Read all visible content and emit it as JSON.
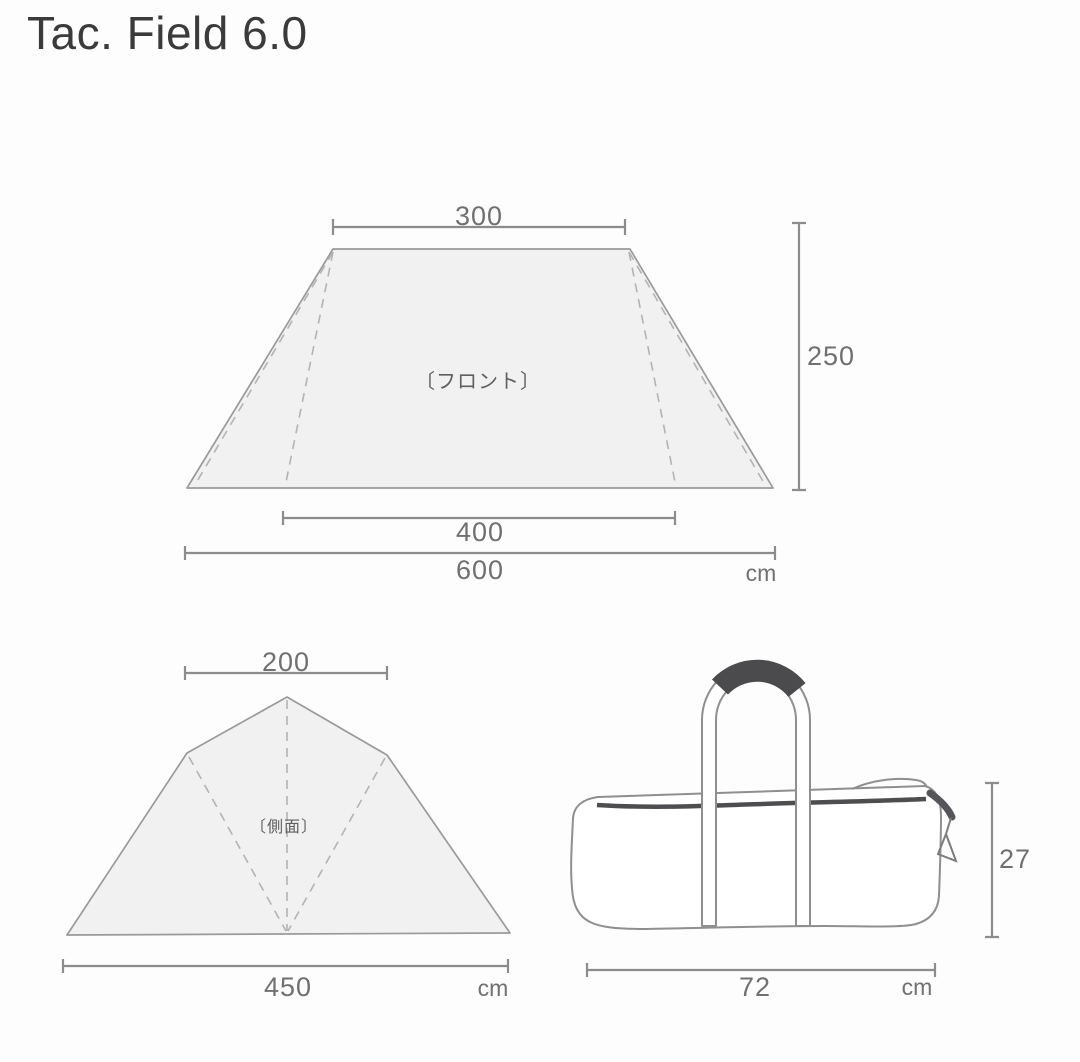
{
  "title": "Tac. Field 6.0",
  "front_view": {
    "label": "〔フロント〕",
    "top_width": "300",
    "height": "250",
    "inner_width": "400",
    "total_width": "600",
    "unit": "cm"
  },
  "side_view": {
    "label": "〔側面〕",
    "top_width": "200",
    "base_width": "450",
    "unit": "cm"
  },
  "carry_bag": {
    "height": "27",
    "width": "72",
    "unit": "cm"
  },
  "colors": {
    "background": "#fdfdfd",
    "title_text": "#3b3b3b",
    "dim_line": "#8c8c8c",
    "dim_text": "#707070",
    "label_text": "#5f5f5f",
    "shape_outline": "#9a9a9a",
    "shape_fill": "#f1f1f2",
    "dashed_line": "#b3b3b3",
    "bag_outline": "#8f8f8f",
    "zipper": "#4e4e50",
    "grip": "#4b4b4d"
  }
}
